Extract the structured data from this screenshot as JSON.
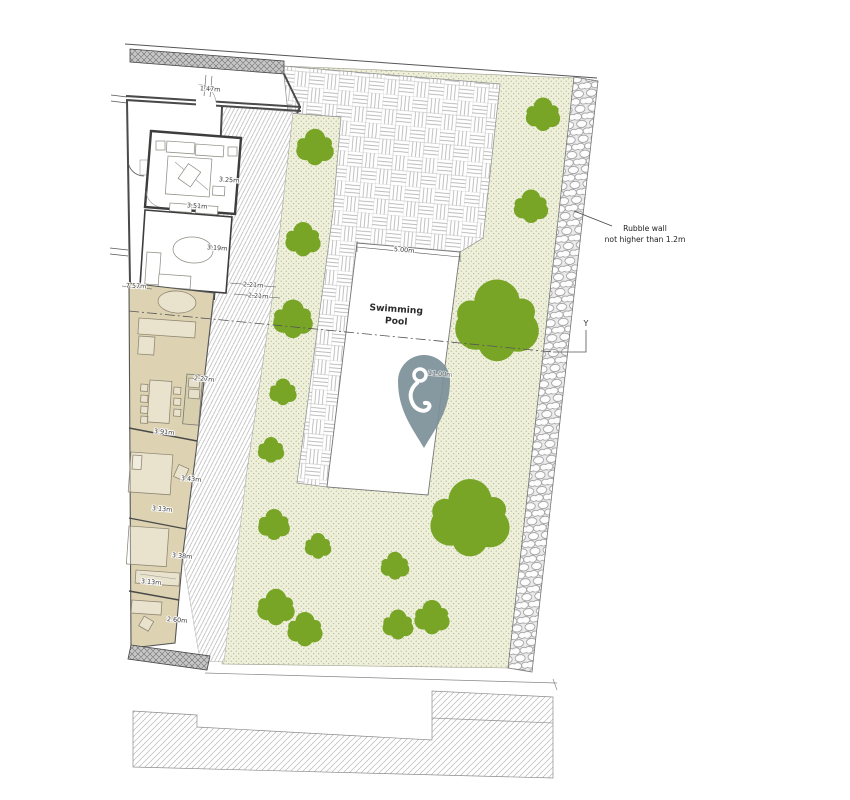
{
  "pool": {
    "label_line1": "Swimming",
    "label_line2": "Pool",
    "width_dim": "5.00m",
    "length_dim": "11.00m"
  },
  "annotations": {
    "rubble_wall_line1": "Rubble wall",
    "rubble_wall_line2": "not higher than 1.2m",
    "section_marker": "Y"
  },
  "dimensions": [
    "1.47m",
    "3.25m",
    "3.51m",
    "3.19m",
    "7.57m",
    "2.21m",
    "2.21m",
    "2.27m",
    "3.91m",
    "3.43m",
    "3.13m",
    "3.38m",
    "3.13m",
    "2.60m"
  ],
  "colors": {
    "tree_green": "#79a527",
    "garden_base": "#eef0da",
    "building_tan": "#ddd3b2",
    "pin_slate": "#7d9099"
  },
  "icons": {
    "marker": "map-pin-icon"
  }
}
